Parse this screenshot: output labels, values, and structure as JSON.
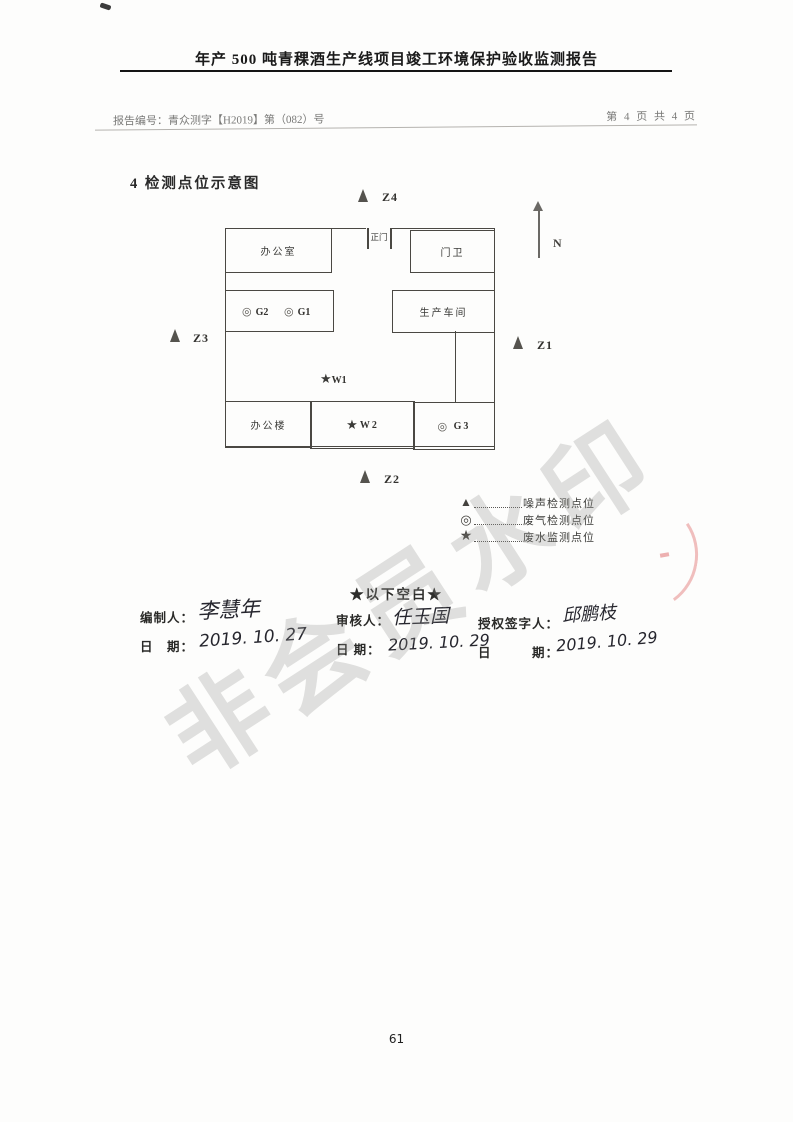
{
  "header": {
    "title": "年产 500 吨青稞酒生产线项目竣工环境保护验收监测报告",
    "report_no": "报告编号：青众测字【H2019】第（082）号",
    "page_indicator": "第 4 页 共 4 页"
  },
  "section": {
    "title": "4 检测点位示意图"
  },
  "diagram": {
    "north_label": "N",
    "buildings": {
      "office_room": "办公室",
      "main_gate": "正门",
      "guard_room": "门卫",
      "workshop": "生产车间",
      "office_building": "办公楼"
    },
    "points": {
      "g1": "G1",
      "g2": "G2",
      "g3": "G3",
      "w1": "W1",
      "w2": "W2",
      "z1": "Z1",
      "z2": "Z2",
      "z3": "Z3",
      "z4": "Z4"
    },
    "symbols": {
      "gas": "◎",
      "water": "★"
    }
  },
  "legend": {
    "items": [
      {
        "symbol": "▲",
        "label": "噪声检测点位"
      },
      {
        "symbol": "◎",
        "label": "废气检测点位"
      },
      {
        "symbol": "★",
        "label": "废水监测点位"
      }
    ]
  },
  "footer_note": "★以下空白★",
  "signatures": {
    "preparer": {
      "label": "编制人：",
      "name": "李慧年",
      "date_label": "日　期：",
      "date": "2019. 10. 27"
    },
    "reviewer": {
      "label": "审核人：",
      "name": "任玉国",
      "date_label": "日 期：",
      "date": "2019. 10. 29"
    },
    "authorizer": {
      "label": "授权签字人：",
      "name": "邱鹏枝",
      "date_label": "日　　　期：",
      "date": "2019. 10. 29"
    }
  },
  "watermark": "非会员水印",
  "page_number": "61",
  "colors": {
    "line": "#4a4843",
    "watermark_gray": "#918f8c",
    "seal_red": "#e07070",
    "scan_text_gray": "#7a7a78"
  }
}
